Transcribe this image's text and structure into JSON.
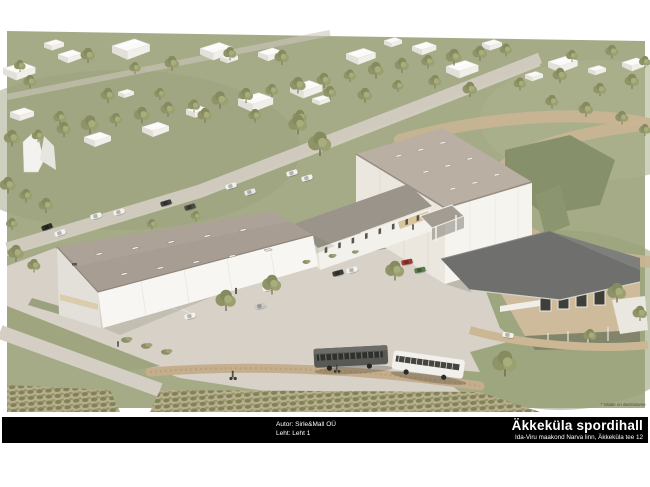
{
  "sheet": {
    "disclaimer": "* Vaade on illustratiivne",
    "stamp": {
      "author_label": "Autor: Sirle&Mall OÜ",
      "sheet_label": "Leht: Leht 1",
      "project_title": "Äkkeküla spordihall",
      "project_address": "Ida-Viru maakond Narva linn, Äkkeküla tee 12"
    },
    "colors": {
      "stamp_bar": "#000000",
      "stamp_text": "#ffffff",
      "field_green": "#a5ab87",
      "dark_green": "#86906a",
      "pavement": "#d7d1c7",
      "dirt_path": "#c5ae8d",
      "roof_left_hall": "#a89d92",
      "roof_right_hall": "#b4aa9f",
      "roof_lodge": "#6f706e",
      "wall_white": "#f7f6f2",
      "tree_olive": "#8f9468"
    }
  }
}
